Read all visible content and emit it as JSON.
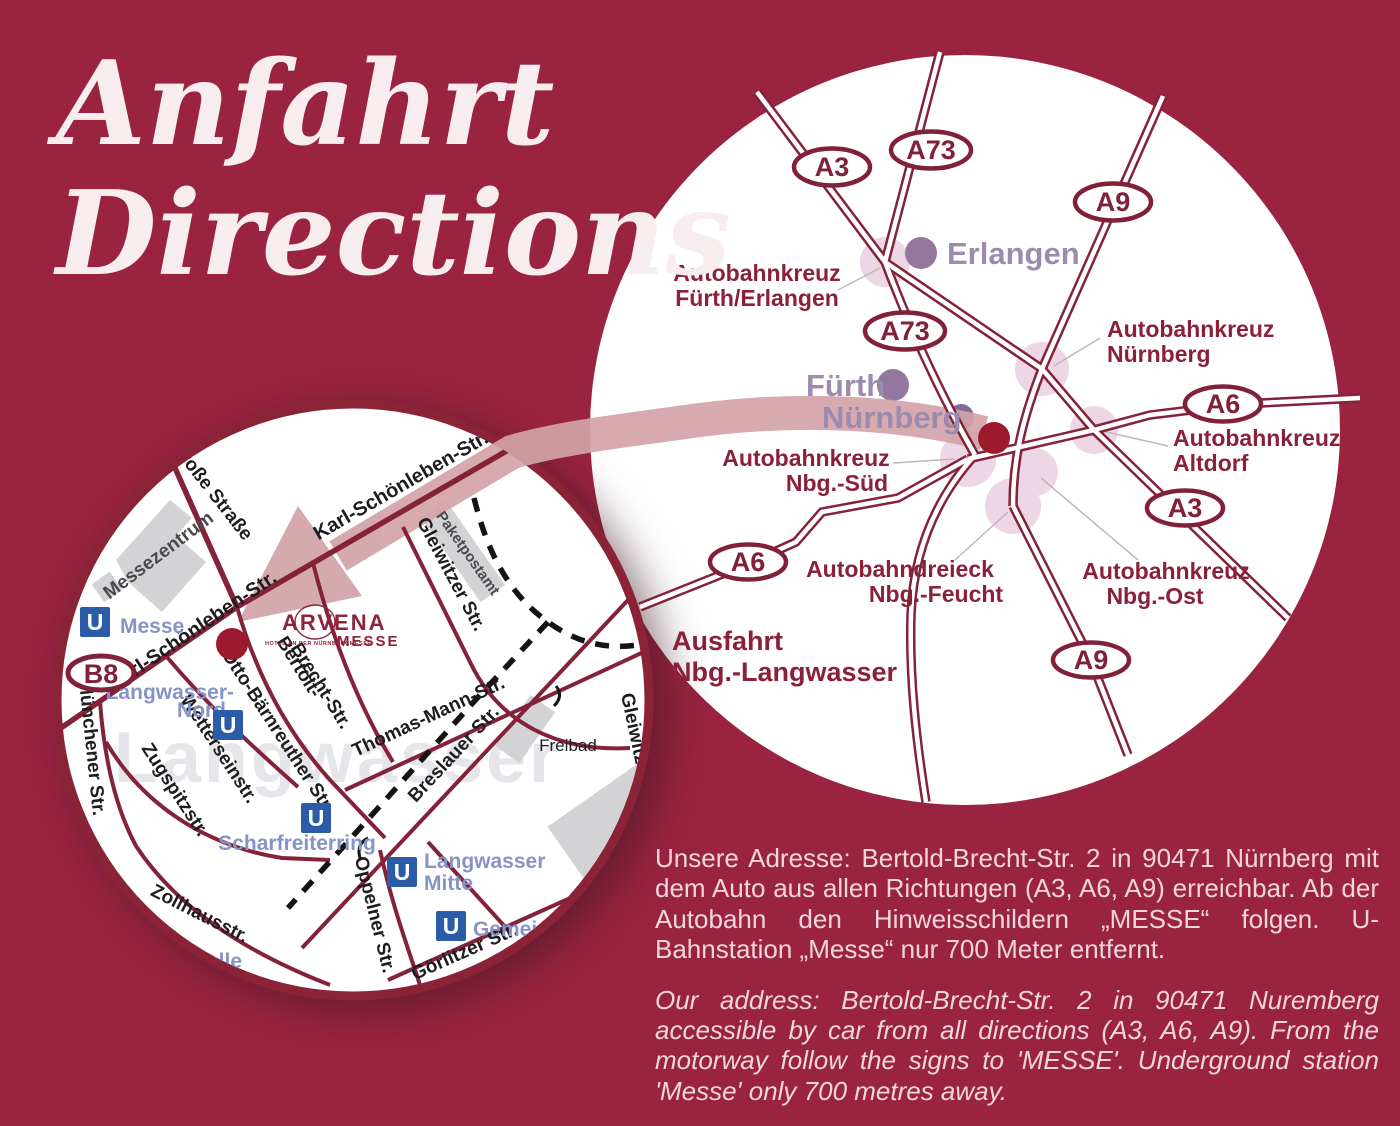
{
  "title": {
    "line1": "Anfahrt",
    "line2": "Directions"
  },
  "colors": {
    "background": "#9A2340",
    "road": "#832239",
    "route_band": "#D2A3A8",
    "junction_blob": "#EDD6E5",
    "city_dot": "#93779F",
    "hotel_marker": "#9C1A2E",
    "ubahn_blue": "#2B5CA8",
    "station_label": "#8693C6"
  },
  "overview_map": {
    "badges": [
      "A3",
      "A73",
      "A9",
      "A73",
      "A6",
      "A3",
      "A6",
      "A9"
    ],
    "cities": [
      "Erlangen",
      "Fürth",
      "Nürnberg"
    ],
    "junctions": [
      {
        "line1": "Autobahnkreuz",
        "line2": "Fürth/Erlangen"
      },
      {
        "line1": "Autobahnkreuz",
        "line2": "Nürnberg"
      },
      {
        "line1": "Autobahnkreuz",
        "line2": "Altdorf"
      },
      {
        "line1": "Autobahnkreuz",
        "line2": "Nbg.-Süd"
      },
      {
        "line1": "Autobahndreieck",
        "line2": "Nbg.-Feucht"
      },
      {
        "line1": "Autobahnkreuz",
        "line2": "Nbg.-Ost"
      }
    ],
    "exit": {
      "line1": "Ausfahrt",
      "line2": "Nbg.-Langwasser"
    }
  },
  "detail_map": {
    "route_badge": "B8",
    "watermark": "Langwasser",
    "hotel_logo": {
      "name": "ARVENA",
      "division": "MESSE",
      "tagline": "HOTEL AN DER NÜRNBERGMESSE"
    },
    "streets": {
      "grosse_strasse": "Große Straße",
      "karl_schoenleben": "Karl-Schönleben-Str.",
      "gleiwitzer": "Gleiwitzer Str.",
      "bertolt_line1": "Bertolt-",
      "bertolt_line2": "Brecht-Str.",
      "otto_baernreuther": "Otto-Bärnreuther Str.",
      "wettersteinstr": "Wetterseinstr.",
      "zugspitzstr": "Zugspitzstr.",
      "muenchener": "Münchener Str.",
      "zollhausstr": "Zollhausstr.",
      "thomas_mann": "Thomas-Mann-Str.",
      "breslauer": "Breslauer Str.",
      "oppelner": "Oppelner Str.",
      "goerlitzer": "Görlitzer Str."
    },
    "places": {
      "messezentrum": "Messezentrum",
      "paketpostamt": "Paketpostamt",
      "freibad": "Freibad",
      "clipped_label": "telle"
    },
    "stations": {
      "u_glyph": "U",
      "messe": "Messe",
      "langwasser_nord_line1": "Langwasser-",
      "langwasser_nord_line2": "Nord",
      "scharfreiterring": "Scharfreiterring",
      "langwasser_mitte_line1": "Langwasser",
      "langwasser_mitte_line2": "Mitte",
      "gemeinschaftshaus": "Gemeinsch"
    }
  },
  "address": {
    "german": "Unsere Adresse: Bertold-Brecht-Str. 2 in 90471 Nürnberg mit dem Auto aus allen Richtungen (A3, A6, A9) erreichbar. Ab der Autobahn den Hinweisschildern „MESSE“ folgen. U-Bahnstation „Messe“ nur 700 Meter entfernt.",
    "english": "Our address: Bertold-Brecht-Str. 2 in 90471 Nuremberg accessible by car from all directions (A3, A6, A9). From the motorway follow the signs to 'MESSE'. Underground station 'Messe' only 700 metres away."
  }
}
